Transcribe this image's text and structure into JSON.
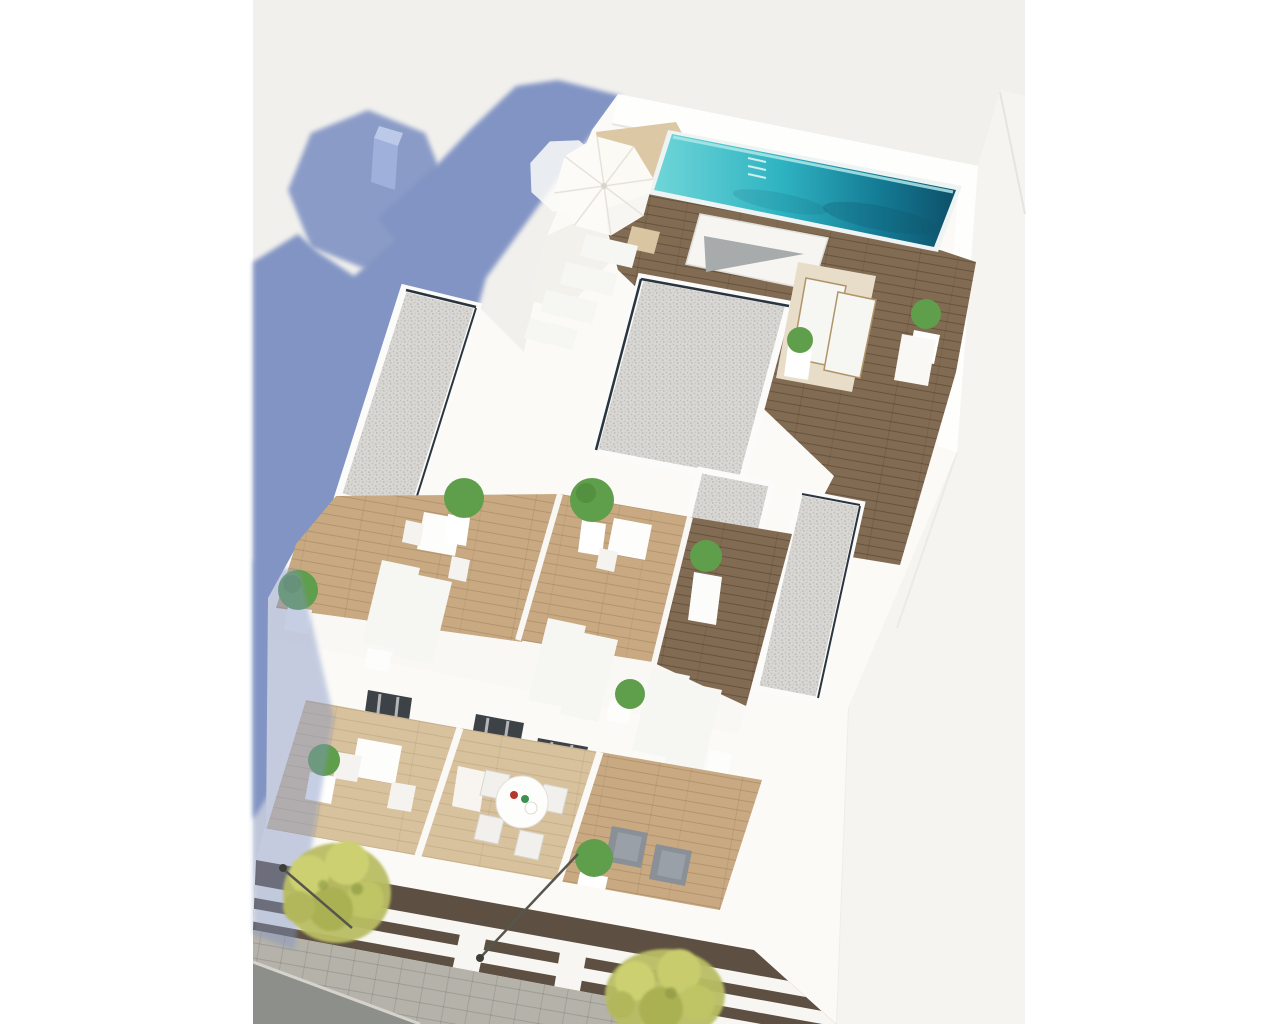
{
  "meta": {
    "title": "Aerial 3D render of residential building with rooftop pool",
    "type": "architectural-3d-render",
    "description": "Top-down aerial rendering of a modern white apartment block. Rooftop has a long turquoise pool with wooden deck, white parasols, sun loungers, gravel-covered roof sections and private terraces with potted plants. Lower floors show balconies with dining tables, armchairs and glass doors. A shadowed street with trees, pavement and lamp posts runs along the lower-left. A large periwinkle-blue building shadow is cast on the ground at the upper left."
  },
  "colors": {
    "page_bg": "#ffffff",
    "render_bg": "#f1f0ed",
    "neighbor_roof": "#f5f4f0",
    "edge_line": "#e6e4dd",
    "shadow_blue": "#8294c4",
    "shadow_cube": "#9fb1da",
    "shadow_cube_top": "#bcc9e8",
    "building_white": "#fbfaf7",
    "parapet_white": "#fefefc",
    "wall_highlight": "#f3f1ec",
    "tan_platform": "#ddc8a6",
    "pool_light": "#6fd6d8",
    "pool_mid": "#2fb3c2",
    "pool_deep": "#157c96",
    "pool_dark": "#0d4f68",
    "pool_coping": "#eef4f4",
    "pool_rim": "#aee8e8",
    "deck_wood": "#826b53",
    "terrace_wood": "#c8a982",
    "balcony_wood": "#d8c29d",
    "gravel": "#d8d7d3",
    "gravel_dot": "#bfbeba",
    "slot_dark": "#2a3540",
    "stair_gray": "#a7abac",
    "box_gray": "#8b8e90",
    "plant_green": "#5f9e4a",
    "plant_dark": "#3f7a33",
    "pot_white": "#ffffff",
    "lounger_white": "#f6f6f3",
    "mat_beige": "#e8ddc8",
    "chair_gray": "#8b8f96",
    "chair_gray_light": "#9aa0a8",
    "door_glass": "#3d4246",
    "curtain_gray": "#b4b6b9",
    "facade_dark": "#5d4f41",
    "facade_band": "#f7f6f2",
    "paver": "#b4b2a9",
    "asphalt": "#8d8f8a",
    "curb": "#d5d3cc",
    "tree_green": "#b9bd62",
    "tree_light": "#ccd06f",
    "tree_dark": "#879440",
    "lamp_post": "#56564f",
    "umbrella_white": "#fcfbf8",
    "umbrella_rib": "#e6e3dc",
    "table_white": "#fdfdfc",
    "table_item_red": "#b4372a",
    "table_item_green": "#3f8f4f",
    "towel_white": "#fbfaf8"
  },
  "scene": {
    "rooftop": {
      "pool": {
        "label": "rooftop swimming pool",
        "water": "turquoise gradient, darker deep end on right",
        "ladder": true
      },
      "parasols": {
        "count": 2,
        "color": "white"
      },
      "sun_loungers": {
        "poolside_rows": 2,
        "terrace_pairs": 3,
        "total_visible": 12
      },
      "gravel_roof_sections": {
        "count": 4,
        "finish": "light gray gravel with white parapet and dark skylight slot"
      },
      "terraces": {
        "count": 5,
        "floor": "light wood planks"
      },
      "potted_plants": {
        "count": 10,
        "pot": "white",
        "foliage": "green shrub"
      }
    },
    "balcony_level": {
      "balconies": 3,
      "round_dining_table": {
        "seats": 4,
        "items": [
          "red bowl",
          "green bowl",
          "white plate"
        ]
      },
      "square_table": {
        "seats": 2
      },
      "gray_armchairs": 2,
      "glass_doors": {
        "count": 5,
        "curtains": "gray"
      }
    },
    "street": {
      "trees": 2,
      "lamp_posts": 2,
      "surfaces": [
        "paved sidewalk",
        "asphalt road"
      ],
      "shadow": "large blue building shadow with parasol silhouette cast upper-left"
    }
  }
}
